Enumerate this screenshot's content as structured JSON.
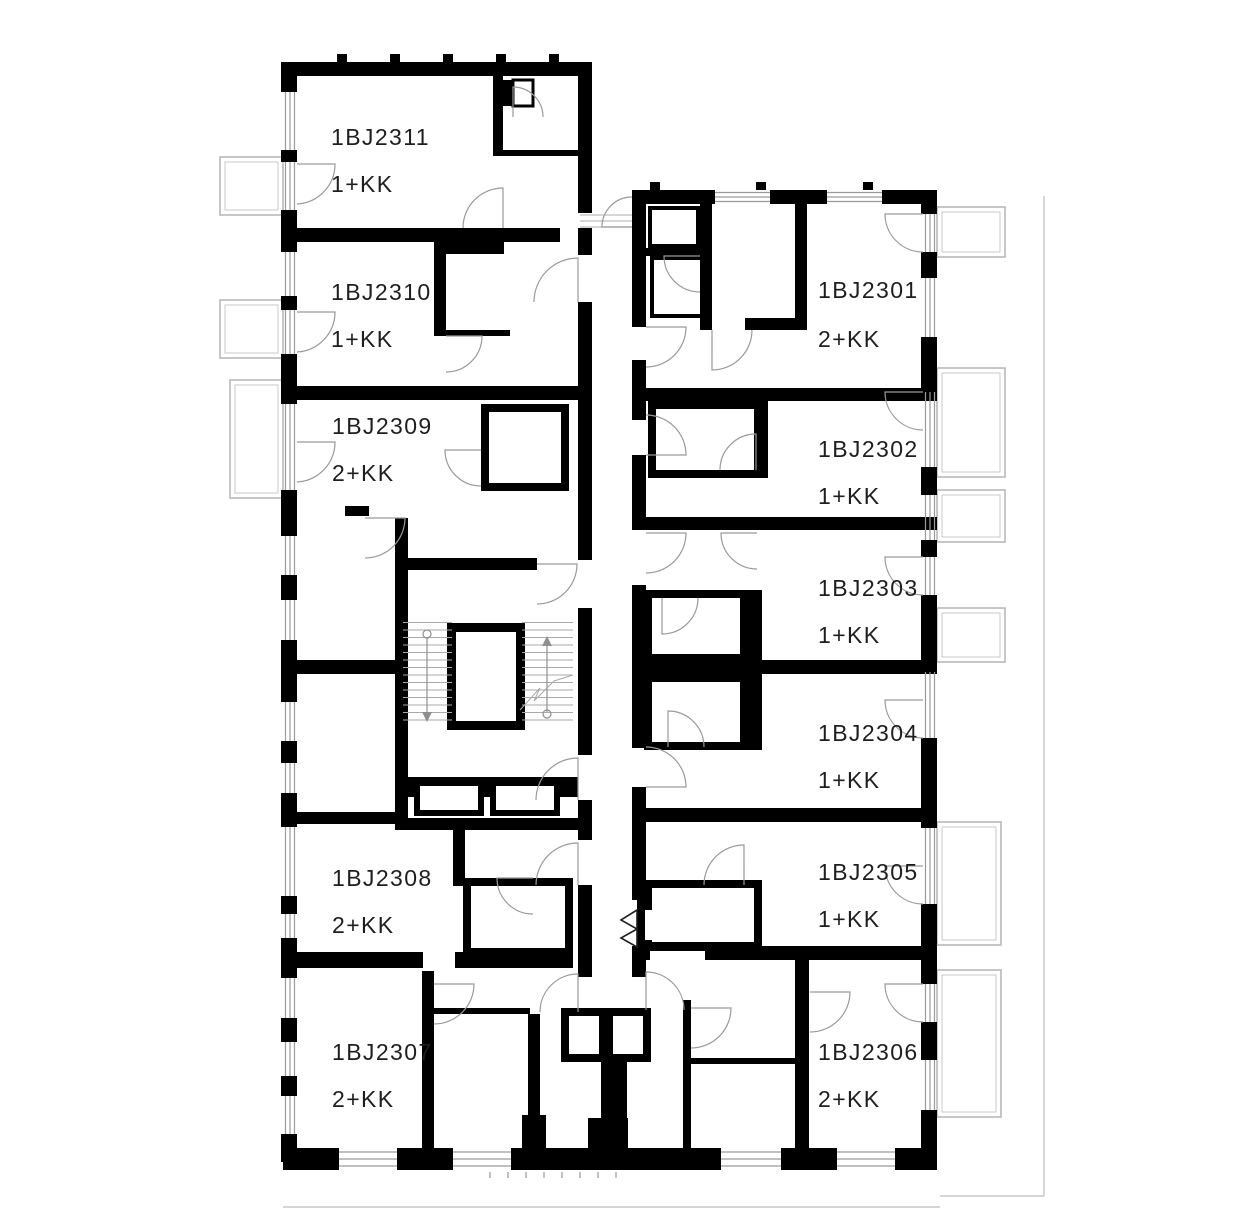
{
  "plan": {
    "units": [
      {
        "id": "1BJ2311",
        "layout": "1+KK"
      },
      {
        "id": "1BJ2310",
        "layout": "1+KK"
      },
      {
        "id": "1BJ2309",
        "layout": "2+KK"
      },
      {
        "id": "1BJ2308",
        "layout": "2+KK"
      },
      {
        "id": "1BJ2307",
        "layout": "2+KK"
      },
      {
        "id": "1BJ2301",
        "layout": "2+KK"
      },
      {
        "id": "1BJ2302",
        "layout": "1+KK"
      },
      {
        "id": "1BJ2303",
        "layout": "1+KK"
      },
      {
        "id": "1BJ2304",
        "layout": "1+KK"
      },
      {
        "id": "1BJ2305",
        "layout": "1+KK"
      },
      {
        "id": "1BJ2306",
        "layout": "2+KK"
      }
    ],
    "colors": {
      "wall": "#000000",
      "thin_line": "#9a9a9a",
      "facade": "#bdbdbd",
      "text": "#1e1e1e",
      "background": "#ffffff"
    }
  }
}
